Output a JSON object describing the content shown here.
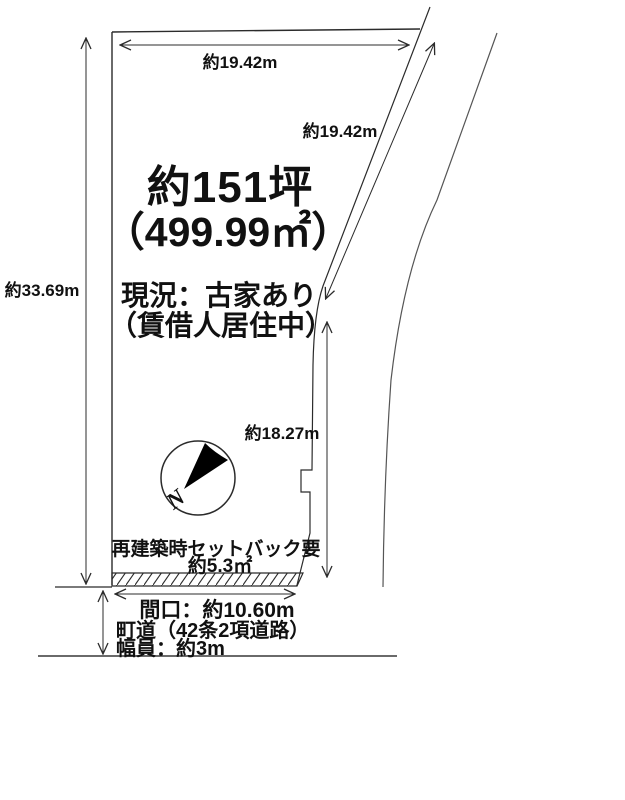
{
  "diagram": {
    "area": {
      "tsubo": "約151坪",
      "square_meters": "（499.99㎡）"
    },
    "status": {
      "line1": "現況：古家あり",
      "line2": "（賃借人居住中）"
    },
    "dimensions": {
      "left_height": "約33.69m",
      "top_width": "約19.42m",
      "diagonal_side": "約19.42m",
      "right_side": "約18.27m",
      "frontage": "間口：約10.60m"
    },
    "setback": {
      "line1": "再建築時セットバック要",
      "line2": "約5.3㎡"
    },
    "road": {
      "line1": "町道（42条2項道路）",
      "line2": "幅員：約3m"
    },
    "compass": {
      "north_label": "N"
    },
    "colors": {
      "line": "#2b2b2b",
      "text": "#111111",
      "needle": "#000000",
      "background": "#ffffff"
    }
  }
}
